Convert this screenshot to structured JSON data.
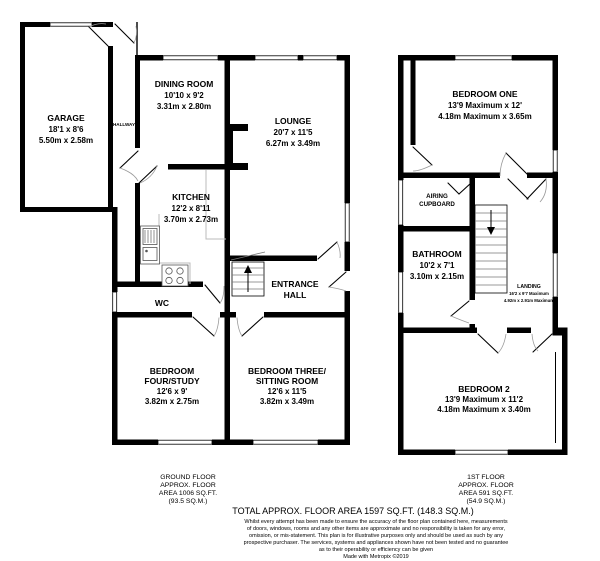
{
  "colors": {
    "wall": "#000000",
    "background": "#ffffff"
  },
  "ground_floor": {
    "rooms": {
      "garage": {
        "name": "GARAGE",
        "dims_ft": "18'1 x 8'6",
        "dims_m": "5.50m x 2.58m"
      },
      "hallway": {
        "name": "HALLWAY"
      },
      "dining_room": {
        "name": "DINING ROOM",
        "dims_ft": "10'10 x 9'2",
        "dims_m": "3.31m x 2.80m"
      },
      "lounge": {
        "name": "LOUNGE",
        "dims_ft": "20'7 x 11'5",
        "dims_m": "6.27m x 3.49m"
      },
      "kitchen": {
        "name": "KITCHEN",
        "dims_ft": "12'2 x 8'11",
        "dims_m": "3.70m x 2.73m"
      },
      "entrance_hall": {
        "line1": "ENTRANCE",
        "line2": "HALL"
      },
      "wc": {
        "name": "WC"
      },
      "bedroom_four": {
        "line1": "BEDROOM",
        "line2": "FOUR/STUDY",
        "dims_ft": "12'6 x 9'",
        "dims_m": "3.82m x 2.75m"
      },
      "bedroom_three": {
        "line1": "BEDROOM THREE/",
        "line2": "SITTING ROOM",
        "dims_ft": "12'6 x 11'5",
        "dims_m": "3.82m x 3.49m"
      }
    },
    "area": {
      "line1": "GROUND FLOOR",
      "line2": "APPROX. FLOOR",
      "line3": "AREA 1006 SQ.FT.",
      "line4": "(93.5 SQ.M.)"
    }
  },
  "first_floor": {
    "rooms": {
      "bedroom_one": {
        "name": "BEDROOM ONE",
        "dims_ft": "13'9 Maximum x 12'",
        "dims_m": "4.18m Maximum x 3.65m"
      },
      "airing_cupboard": {
        "line1": "AIRING",
        "line2": "CUPBOARD"
      },
      "bathroom": {
        "name": "BATHROOM",
        "dims_ft": "10'2 x 7'1",
        "dims_m": "3.10m x 2.15m"
      },
      "landing": {
        "name": "LANDING",
        "dims_ft": "16'2 x 9'7 Maximum",
        "dims_m": "4.92m x 2.91m Maximum"
      },
      "bedroom_two": {
        "name": "BEDROOM 2",
        "dims_ft": "13'9 Maximum x 11'2",
        "dims_m": "4.18m Maximum x 3.40m"
      }
    },
    "area": {
      "line1": "1ST FLOOR",
      "line2": "APPROX. FLOOR",
      "line3": "AREA 591 SQ.FT.",
      "line4": "(54.9 SQ.M.)"
    }
  },
  "footer": {
    "total": "TOTAL APPROX. FLOOR AREA 1597 SQ.FT. (148.3 SQ.M.)",
    "disclaimer": [
      "Whilst every attempt has been made to ensure the accuracy of the floor plan contained here, measurements",
      "of doors, windows, rooms and any other items are approximate and no responsibility is taken for any error,",
      "omission, or mis-statement. This plan is for illustrative purposes only and should be used as such by any",
      "prospective purchaser. The services, systems and appliances shown have not been tested and no guarantee",
      "as to their operability or efficiency can be given"
    ],
    "credit": "Made with Metropix ©2019"
  }
}
